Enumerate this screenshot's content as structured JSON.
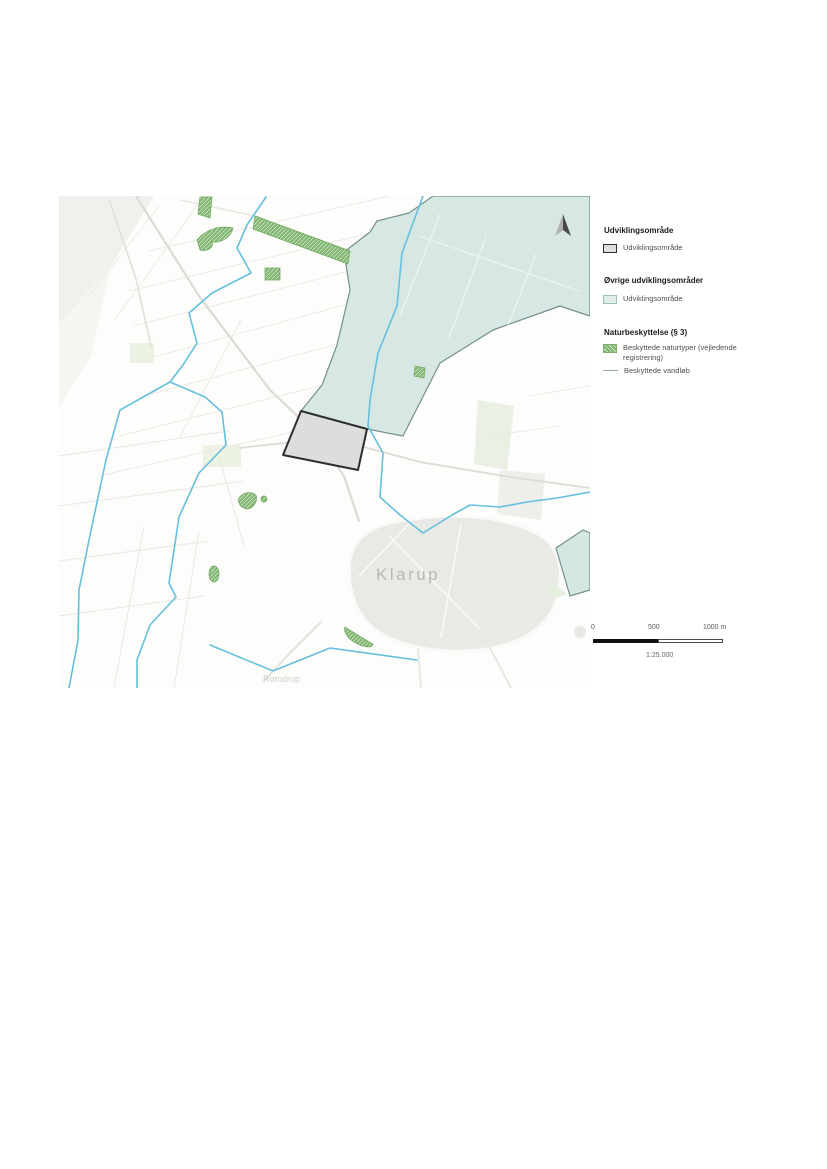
{
  "figure": {
    "type": "map",
    "town_label": "Klarup",
    "village_label": "Romdrup",
    "north_arrow_icon": "north-arrow"
  },
  "legend": {
    "sections": [
      {
        "title": "Udviklingsområde",
        "items": [
          {
            "label": "Udviklingsområde",
            "swatch": "development-area-swatch"
          }
        ]
      },
      {
        "title": "Øvrige udviklingsområder",
        "items": [
          {
            "label": "Udviklingsområde",
            "swatch": "other-development-area-swatch"
          }
        ]
      },
      {
        "title": "Naturbeskyttelse (§ 3)",
        "items": [
          {
            "label": "Beskyttede naturtyper (vejledende registrering)",
            "swatch": "protected-nature-swatch"
          },
          {
            "label": "Beskyttede vandløb",
            "swatch": "protected-stream-swatch"
          }
        ]
      }
    ]
  },
  "scalebar": {
    "tick_labels": [
      "0",
      "500",
      "1000 m"
    ],
    "ratio": "1:25.000"
  },
  "colors": {
    "development_area_fill": "#dddddb",
    "development_area_border": "#2e2e2e",
    "other_development_fill": "#d5e7e3",
    "other_development_border": "#72908d",
    "protected_nature_green": "#7fb56e",
    "protected_stream_blue": "#64c0dd",
    "town_label_gray": "#b7b7b4"
  }
}
